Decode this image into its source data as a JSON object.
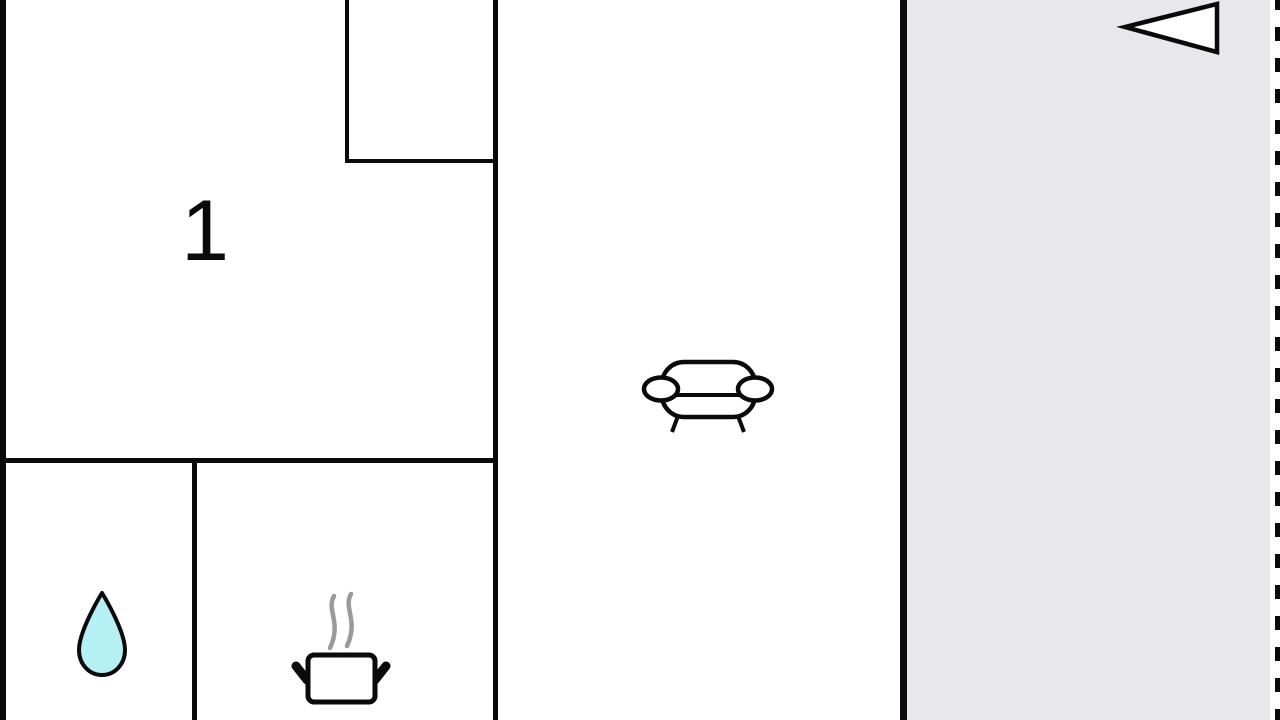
{
  "floorplan": {
    "room_label": "1",
    "colors": {
      "wall": "#0a0a0a",
      "background": "#ffffff",
      "terrace_fill": "#e8e8ec",
      "water_drop_fill": "#b5f1f4",
      "steam": "#9a9a9a"
    },
    "icons": {
      "bathroom": "water-drop-icon",
      "kitchen": "steaming-pot-icon",
      "living_room": "sofa-icon",
      "terrace": "entrance-triangle-icon"
    }
  }
}
